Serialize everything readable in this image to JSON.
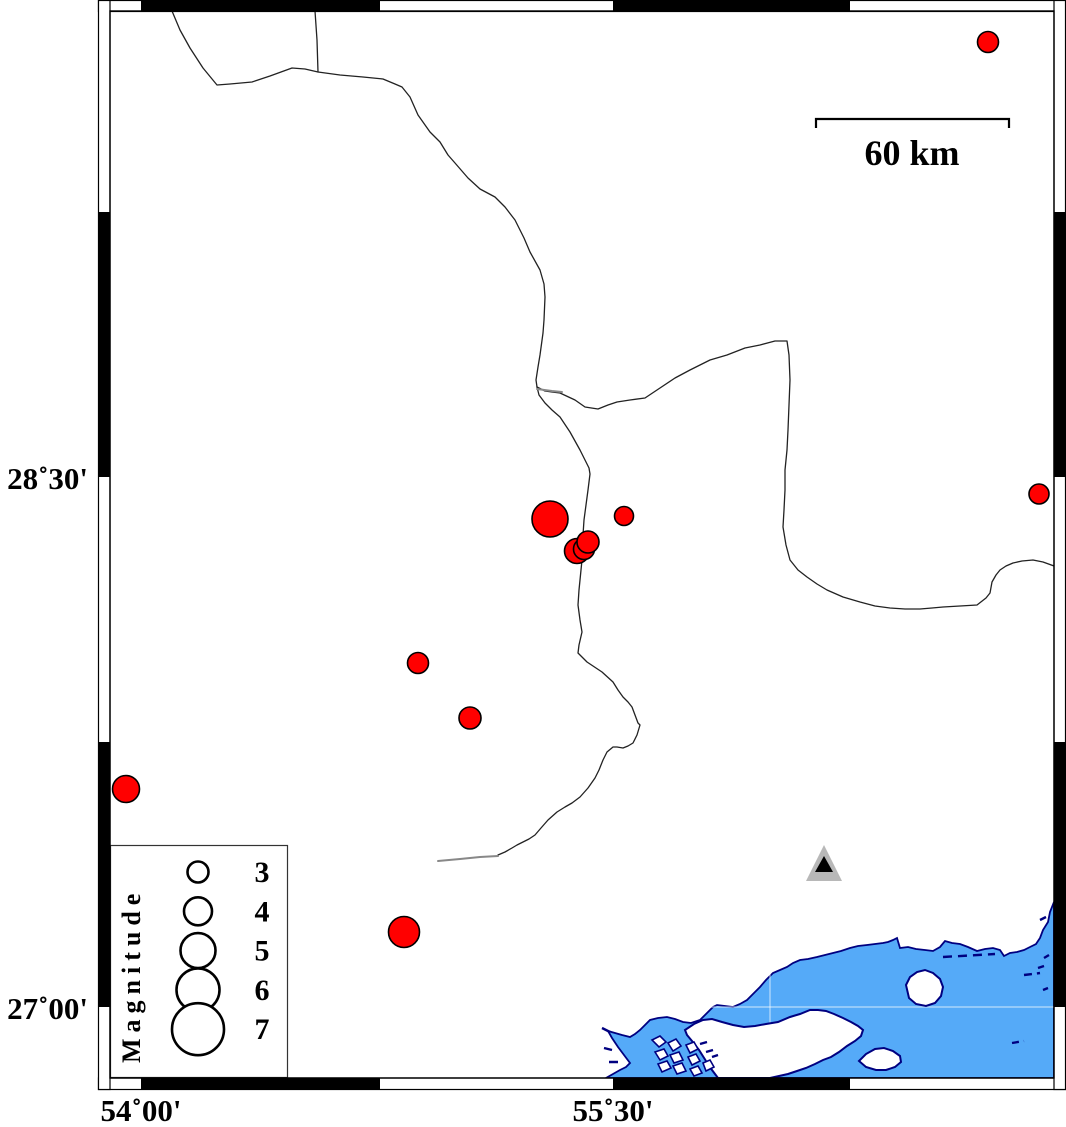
{
  "map": {
    "axis_labels": {
      "left": [
        {
          "text": "28˚30'"
        },
        {
          "text": "27˚00'"
        }
      ],
      "bottom": [
        {
          "text": "54˚00'"
        },
        {
          "text": "55˚30'"
        }
      ]
    },
    "scale_bar": {
      "label": "60 km",
      "length_km": 60
    },
    "earthquakes": [
      {
        "x": 988,
        "y": 42,
        "r": 10.5
      },
      {
        "x": 1039,
        "y": 494,
        "r": 10
      },
      {
        "x": 550,
        "y": 519,
        "r": 18
      },
      {
        "x": 624,
        "y": 516,
        "r": 9.5
      },
      {
        "x": 577,
        "y": 551,
        "r": 12.5
      },
      {
        "x": 584,
        "y": 549,
        "r": 10.5
      },
      {
        "x": 588,
        "y": 542,
        "r": 11
      },
      {
        "x": 418,
        "y": 663,
        "r": 10.5
      },
      {
        "x": 470,
        "y": 718,
        "r": 11
      },
      {
        "x": 126,
        "y": 789,
        "r": 13.5
      },
      {
        "x": 404,
        "y": 932,
        "r": 15.5
      }
    ],
    "station": {
      "x": 824,
      "y": 866
    },
    "colors": {
      "quake": "#ff0000",
      "sea": "#55aaf8",
      "coast": "#000080",
      "boundary": "#222222",
      "station_outer": "#b8b8b8",
      "station_inner": "#000000"
    }
  },
  "legend": {
    "title": "Magnitude",
    "entries": [
      {
        "label": "3",
        "r": 10.5
      },
      {
        "label": "4",
        "r": 14
      },
      {
        "label": "5",
        "r": 17.5
      },
      {
        "label": "6",
        "r": 21.5
      },
      {
        "label": "7",
        "r": 26
      }
    ]
  }
}
